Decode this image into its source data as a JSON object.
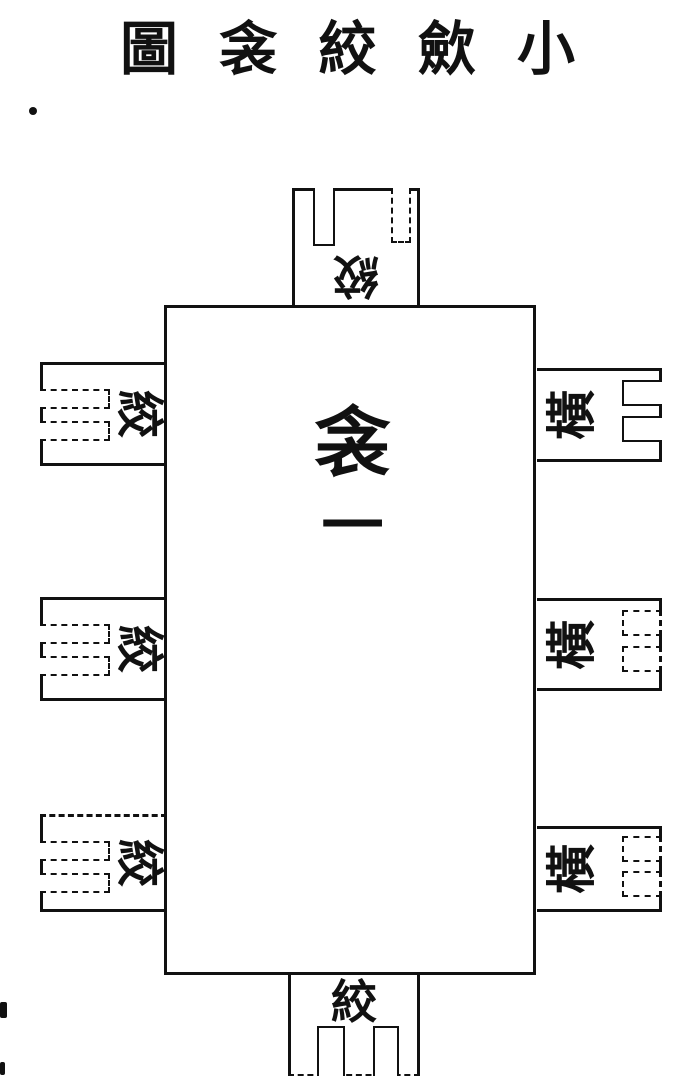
{
  "colors": {
    "ink": "#111111",
    "paper": "#ffffff"
  },
  "title": {
    "text": "小歛絞衾圖",
    "reading_direction": "right-to-left",
    "chars": [
      "圖",
      "衾",
      "絞",
      "歛",
      "小"
    ]
  },
  "center": {
    "label": "衾一",
    "chars": [
      "衾",
      "一"
    ]
  },
  "flaps": {
    "top": {
      "label": "絞",
      "orientation": "rotated-180",
      "notches": 2
    },
    "bottom": {
      "label": "絞",
      "orientation": "upright",
      "notches": 2
    },
    "left": [
      {
        "label": "絞",
        "orientation": "rotated-90-cw",
        "notches": 2
      },
      {
        "label": "絞",
        "orientation": "rotated-90-cw",
        "notches": 2
      },
      {
        "label": "絞",
        "orientation": "rotated-90-cw",
        "notches": 2
      }
    ],
    "right": [
      {
        "label": "橫",
        "orientation": "rotated-90-ccw",
        "notches": 2
      },
      {
        "label": "橫",
        "orientation": "rotated-90-ccw",
        "notches": 2
      },
      {
        "label": "橫",
        "orientation": "rotated-90-ccw",
        "notches": 2
      }
    ]
  }
}
